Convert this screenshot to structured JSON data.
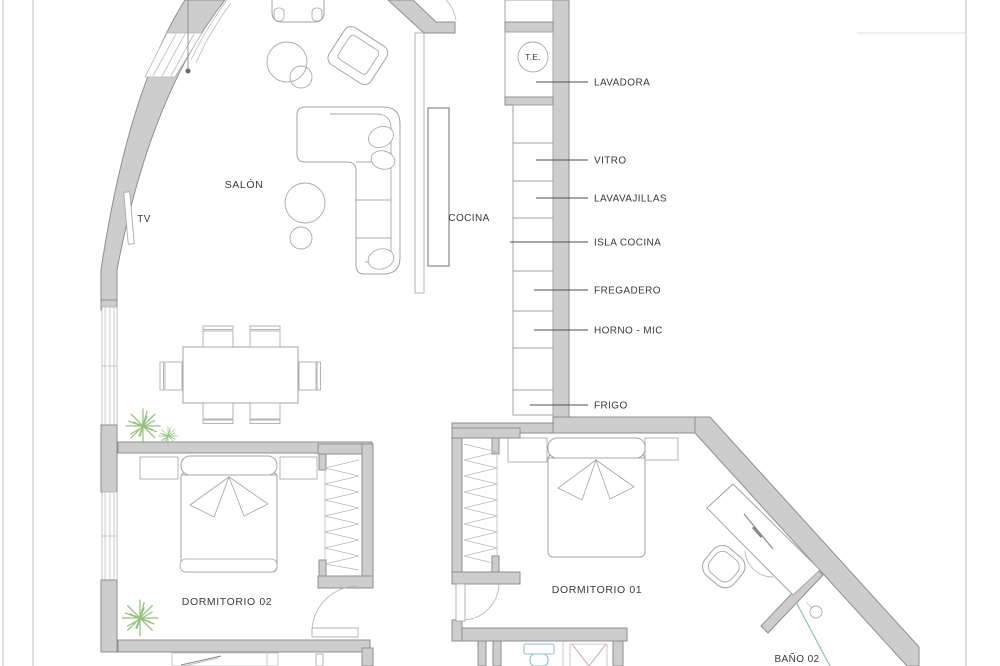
{
  "plan_type": "apartment-floor-plan",
  "rooms": {
    "salon": "SALÓN",
    "cocina": "COCINA",
    "dormitorio_01": "DORMITORIO 01",
    "dormitorio_02": "DORMITORIO 02",
    "bano_02": "BAÑO 02"
  },
  "fixtures": {
    "tv": "TV",
    "thermo": "T.E."
  },
  "kitchen_callouts": [
    {
      "label": "LAVADORA"
    },
    {
      "label": "VITRO"
    },
    {
      "label": "LAVAVAJILLAS"
    },
    {
      "label": "ISLA COCINA"
    },
    {
      "label": "FREGADERO"
    },
    {
      "label": "HORNO - MIC"
    },
    {
      "label": "FRIGO"
    }
  ],
  "colors": {
    "background": "#ffffff",
    "wall_fill": "#cdcdcd",
    "wall_stroke": "#8f8f8f",
    "furniture_stroke": "#a3a3a3",
    "leader_line": "#4f4f4f",
    "label_text": "#3a3a3a",
    "plant_green": "#94c07c",
    "toilet_teal": "#8ec7c4",
    "shower_red": "#d6a3a3"
  }
}
